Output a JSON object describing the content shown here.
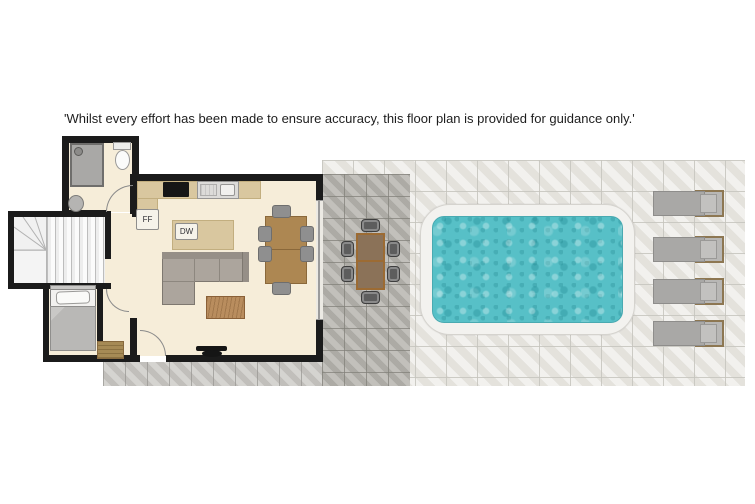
{
  "disclaimer": "'Whilst every effort has been made to ensure accuracy, this floor plan is provided for guidance only.'",
  "kitchen": {
    "fridge_freezer_label": "FF",
    "dishwasher_label": "DW"
  },
  "outdoor": {
    "sun_lounger_count": 4,
    "outdoor_dining_chair_count": 6
  },
  "indoor": {
    "dining_chair_count": 6
  },
  "colors": {
    "wall": "#1b1b1b",
    "floor": "#f6edd9",
    "counter": "#d9c79f",
    "sofa": "#aca59d",
    "wood_table": "#ad8752",
    "coffee": "#b98d5e",
    "chair": "#8f8f8f",
    "stairs": "#f1f1f1",
    "patio": "#b6b4ae",
    "deck": "#eae8e3",
    "strip": "#c7c5c1",
    "water": "#57c0c7",
    "coping": "#f3f2ef",
    "lounger_cushion": "#a9a8a6",
    "lounger_wood": "#8d7752",
    "outdoor_table": "#8b7258",
    "outdoor_table_edge": "#9c6b33",
    "mat": "#a68a55",
    "blanket": "#b9b8b6"
  }
}
